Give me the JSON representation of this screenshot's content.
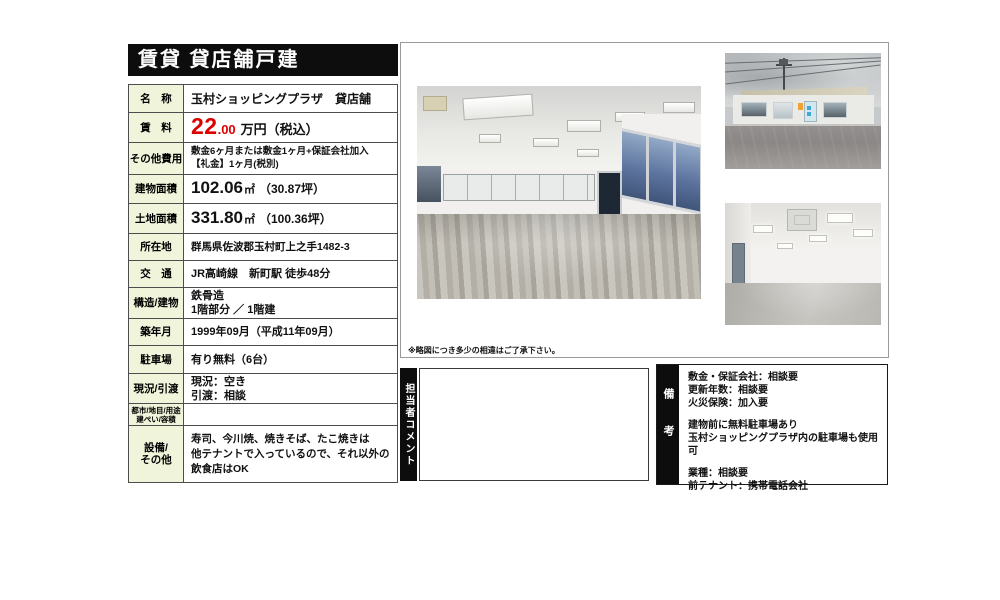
{
  "title": "賃貸 貸店舗戸建",
  "colors": {
    "title_bg": "#0d0d0d",
    "label_bg": "#f0f4da",
    "price_red": "#dd0000",
    "border": "#4d4d4d"
  },
  "table": {
    "rows": {
      "name": {
        "label": "名　称",
        "value": "玉村ショッピングプラザ　貸店舗"
      },
      "rent": {
        "label": "賃　料",
        "amount": "22",
        "decimal": ".00",
        "suffix": "万円（税込）"
      },
      "other_fees": {
        "label": "その他費用",
        "line1": "敷金6ヶ月または敷金1ヶ月+保証会社加入",
        "line2": "【礼金】1ヶ月(税別)"
      },
      "building_area": {
        "label": "建物面積",
        "num": "102.06",
        "unit": "㎡",
        "paren": "（30.87坪）"
      },
      "land_area": {
        "label": "土地面積",
        "num": "331.80",
        "unit": "㎡",
        "paren": "（100.36坪）"
      },
      "address": {
        "label": "所在地",
        "value": "群馬県佐波郡玉村町上之手1482-3"
      },
      "access": {
        "label": "交　通",
        "value": "JR高崎線　新町駅 徒歩48分"
      },
      "structure": {
        "label": "構造/建物",
        "line1": "鉄骨造",
        "line2": "1階部分 ／ 1階建"
      },
      "built": {
        "label": "築年月",
        "value": "1999年09月（平成11年09月）"
      },
      "parking": {
        "label": "駐車場",
        "value": "有り無料（6台）"
      },
      "status": {
        "label": "現況/引渡",
        "line1": "現況：空き",
        "line2": "引渡：相談"
      },
      "zoning": {
        "label_line1": "都市/地目/用途",
        "label_line2": "建ぺい/容積",
        "value": ""
      },
      "facilities": {
        "label_line1": "設備/",
        "label_line2": "その他",
        "line1": "寿司、今川焼、焼きそば、たこ焼きは",
        "line2": "他テナントで入っているので、それ以外の",
        "line3": "飲食店はOK"
      }
    }
  },
  "photos": {
    "disclaimer": "※略図につき多少の相違はご了承下さい。",
    "main": "interior-sales-floor-photo",
    "exterior": "building-exterior-photo",
    "interior2": "interior-second-view-photo"
  },
  "staff_comment": {
    "label": "担当者コメント",
    "content": ""
  },
  "notes": {
    "label": "備考",
    "group1": {
      "line1": "敷金・保証会社：相談要",
      "line2": "更新年数：相談要",
      "line3": "火災保険：加入要"
    },
    "group2": {
      "line1": "建物前に無料駐車場あり",
      "line2": "玉村ショッピングプラザ内の駐車場も使用可"
    },
    "group3": {
      "line1": "業種：相談要",
      "line2": "前テナント：携帯電話会社"
    }
  }
}
